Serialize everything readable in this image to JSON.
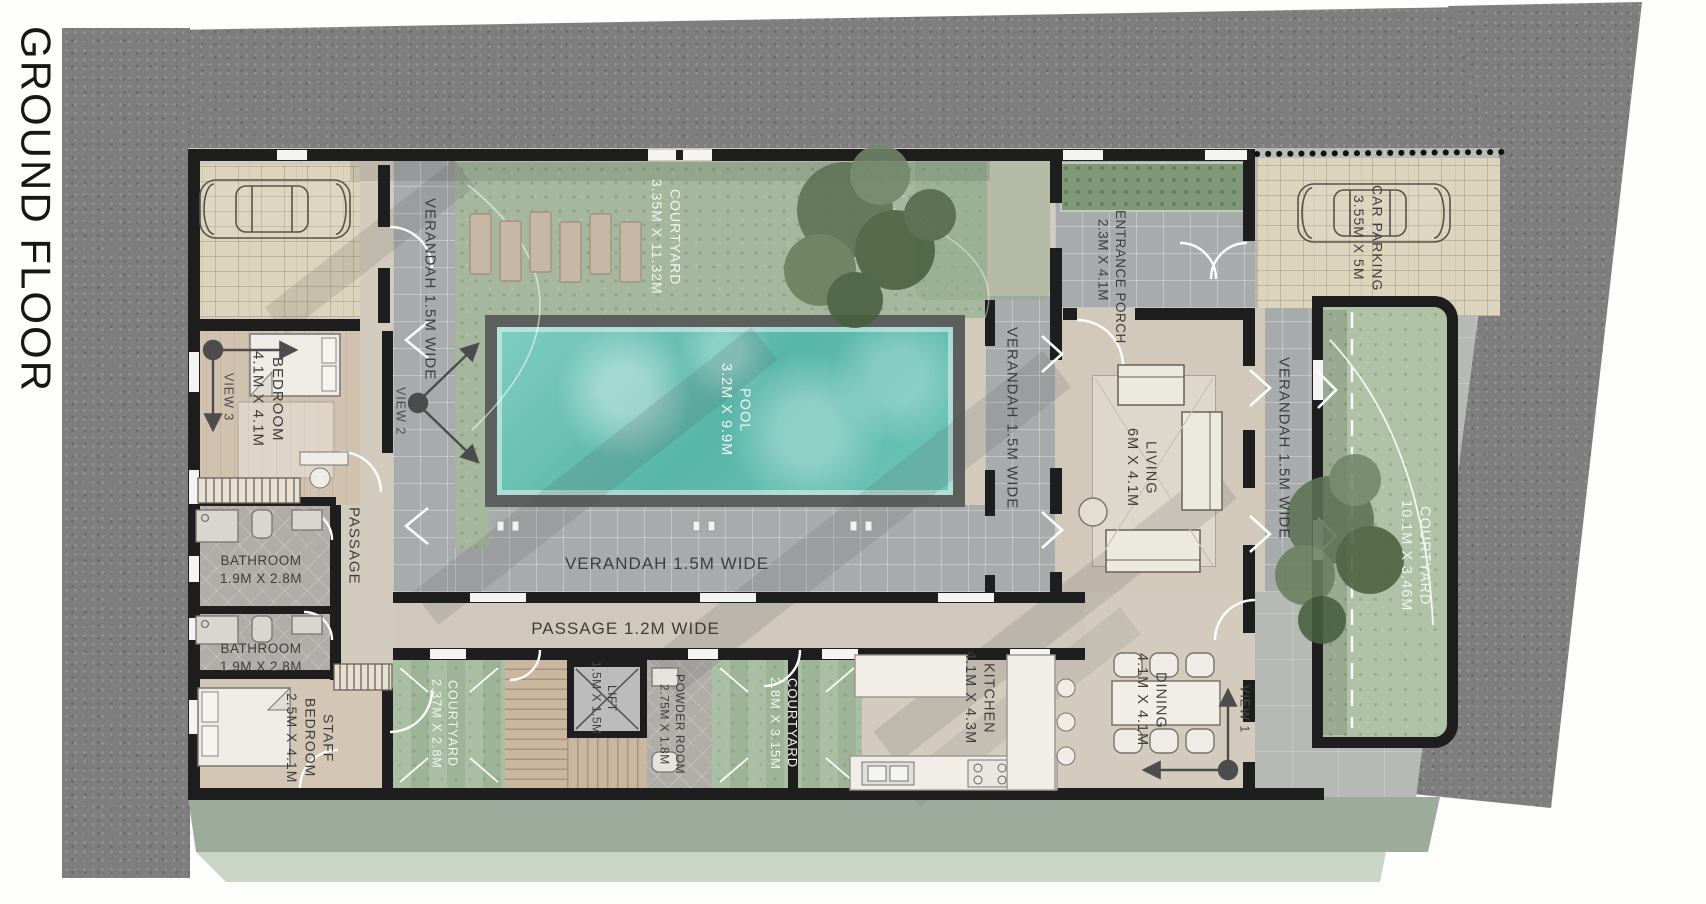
{
  "title": "GROUND FLOOR",
  "colors": {
    "road": "#7e7e7e",
    "plot_paving": "#b6b9b5",
    "stone_paving": "#dcd4bc",
    "wall": "#1e1e1e",
    "pool_water": "#66c1b5",
    "grass": "#a5b89e",
    "floor_beige": "#d3cbbe",
    "label_dark": "#3d3d3d",
    "label_light": "#f2f5f0"
  },
  "rooms": {
    "verandah_left": {
      "label": "VERANDAH 1.5M WIDE"
    },
    "verandah_pool": {
      "label": "VERANDAH 1.5M WIDE"
    },
    "verandah_mid": {
      "label": "VERANDAH 1.5M WIDE"
    },
    "verandah_right": {
      "label": "VERANDAH 1.5M WIDE"
    },
    "courtyard_top": {
      "label": "COURTYARD",
      "dims": "3.35M X 11.32M"
    },
    "courtyard_right": {
      "label": "COURTYARD",
      "dims": "10.1M X 3.46M"
    },
    "courtyard_bl": {
      "label": "COURTYARD",
      "dims": "2.37M X 2.8M"
    },
    "courtyard_bc": {
      "label": "COURTYARD",
      "dims": "2.8M X 3.15M"
    },
    "pool": {
      "label": "POOL",
      "dims": "3.2M X 9.9M"
    },
    "passage_main": {
      "label": "PASSAGE 1.2M WIDE"
    },
    "passage_left": {
      "label": "PASSAGE"
    },
    "bedroom": {
      "label": "BEDROOM",
      "dims": "4.1M X 4.1M"
    },
    "bathroom1": {
      "label": "BATHROOM",
      "dims": "1.9M X 2.8M"
    },
    "bathroom2": {
      "label": "BATHROOM",
      "dims": "1.9M X 2.8M"
    },
    "staff_bedroom": {
      "line1": "STAFF",
      "line2": "BEDROOM",
      "dims": "2.5M X 4.1M"
    },
    "lift": {
      "label": "LIFT",
      "dims": "1.5M X 1.5M"
    },
    "powder_room": {
      "label": "POWDER ROOM",
      "dims": "2.75M X 1.8M"
    },
    "kitchen": {
      "label": "KITCHEN",
      "dims": "4.1M X 4.3M"
    },
    "dining": {
      "label": "DINING",
      "dims": "4.1M X 4.1M"
    },
    "living": {
      "label": "LIVING",
      "dims": "6M X 4.1M"
    },
    "entrance_porch": {
      "label": "ENTRANCE PORCH",
      "dims": "2.3M X 4.1M"
    },
    "car_parking": {
      "label": "CAR PARKING",
      "dims": "3.55M X 5M"
    }
  },
  "views": {
    "v1": "VIEW 1",
    "v2": "VIEW 2",
    "v3": "VIEW 3"
  }
}
